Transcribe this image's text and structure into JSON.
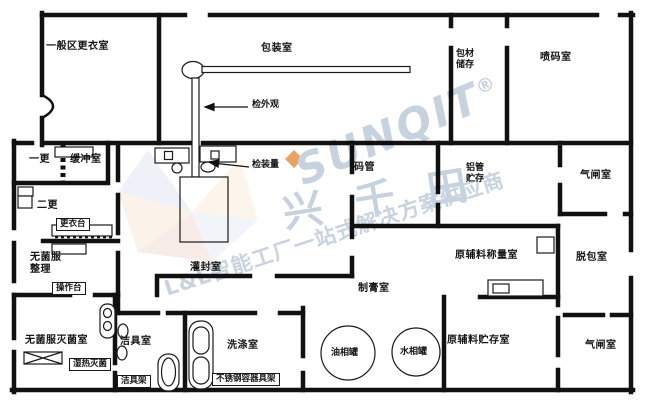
{
  "watermark": {
    "brand_en": "SUNQIT",
    "reg_mark": "®",
    "brand_cn": "兴千田",
    "slogan": "L&L智能工厂一站式解决方案供应商",
    "color": "#c7d2df",
    "accent_color": "#e78a3c"
  },
  "rooms": {
    "general_changing": "一般区更衣室",
    "packaging": "包装室",
    "packmat_storage": "包材\n储存",
    "spray_code": "喷码室",
    "first_change": "一更",
    "buffer": "缓冲室",
    "second_change": "二更",
    "sterile_sorting": "无菌服\n整理",
    "sterile_sterilization": "无菌服灭菌室",
    "cleaning_tools": "洁具室",
    "washing": "洗涤室",
    "filling_sealing": "灌封室",
    "paste_making": "制膏室",
    "tube_coding": "码管",
    "alu_tube_storage": "铝管\n贮存",
    "airlock_top": "气闸室",
    "weighing": "原辅料称量室",
    "depacking": "脱包室",
    "raw_storage": "原辅料贮存室",
    "airlock_bottom": "气闸室"
  },
  "furniture": {
    "gowning_table": "更衣台",
    "operating_table": "操作台",
    "moist_heat_sterilizer": "湿热灭菌",
    "cleaning_rack": "洁具架",
    "ss_container_rack": "不锈钢容器具架",
    "oil_tank": "油相罐",
    "water_tank": "水相罐"
  },
  "annotations": {
    "inspect_appearance": "检外观",
    "inspect_fill_volume": "检装量"
  }
}
